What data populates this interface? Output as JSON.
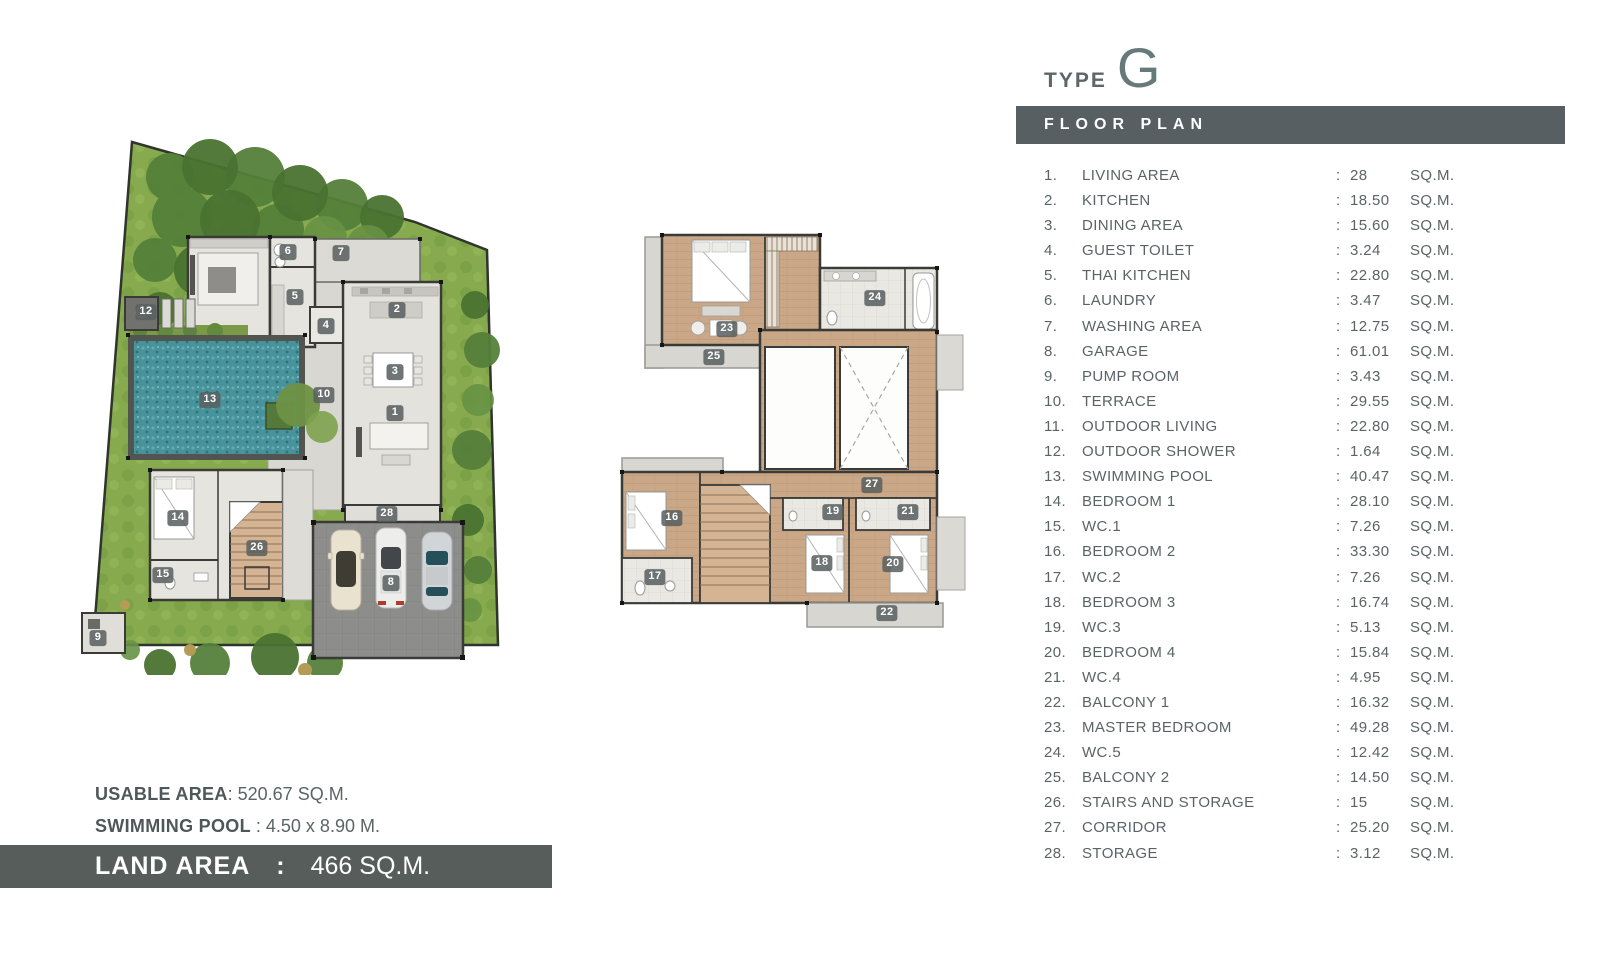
{
  "header": {
    "type_label": "TYPE",
    "type_value": "G",
    "floor_plan_title": "FLOOR PLAN"
  },
  "rooms": [
    {
      "no": "1.",
      "name": "LIVING AREA",
      "value": "28",
      "unit": "SQ.M."
    },
    {
      "no": "2.",
      "name": "KITCHEN",
      "value": "18.50",
      "unit": "SQ.M."
    },
    {
      "no": "3.",
      "name": "DINING AREA",
      "value": "15.60",
      "unit": "SQ.M."
    },
    {
      "no": "4.",
      "name": "GUEST TOILET",
      "value": "3.24",
      "unit": "SQ.M."
    },
    {
      "no": "5.",
      "name": "THAI KITCHEN",
      "value": "22.80",
      "unit": "SQ.M."
    },
    {
      "no": "6.",
      "name": "LAUNDRY",
      "value": "3.47",
      "unit": "SQ.M."
    },
    {
      "no": "7.",
      "name": "WASHING AREA",
      "value": "12.75",
      "unit": "SQ.M."
    },
    {
      "no": "8.",
      "name": "GARAGE",
      "value": "61.01",
      "unit": "SQ.M."
    },
    {
      "no": "9.",
      "name": "PUMP ROOM",
      "value": "3.43",
      "unit": "SQ.M."
    },
    {
      "no": "10.",
      "name": "TERRACE",
      "value": "29.55",
      "unit": "SQ.M."
    },
    {
      "no": "11.",
      "name": "OUTDOOR LIVING",
      "value": "22.80",
      "unit": "SQ.M."
    },
    {
      "no": "12.",
      "name": "OUTDOOR SHOWER",
      "value": "1.64",
      "unit": "SQ.M."
    },
    {
      "no": "13.",
      "name": "SWIMMING POOL",
      "value": "40.47",
      "unit": "SQ.M."
    },
    {
      "no": "14.",
      "name": "BEDROOM 1",
      "value": "28.10",
      "unit": "SQ.M."
    },
    {
      "no": "15.",
      "name": "WC.1",
      "value": "7.26",
      "unit": "SQ.M."
    },
    {
      "no": "16.",
      "name": "BEDROOM 2",
      "value": "33.30",
      "unit": "SQ.M."
    },
    {
      "no": "17.",
      "name": "WC.2",
      "value": "7.26",
      "unit": "SQ.M."
    },
    {
      "no": "18.",
      "name": "BEDROOM 3",
      "value": "16.74",
      "unit": "SQ.M."
    },
    {
      "no": "19.",
      "name": "WC.3",
      "value": "5.13",
      "unit": "SQ.M."
    },
    {
      "no": "20.",
      "name": "BEDROOM 4",
      "value": "15.84",
      "unit": "SQ.M."
    },
    {
      "no": "21.",
      "name": "WC.4",
      "value": "4.95",
      "unit": "SQ.M."
    },
    {
      "no": "22.",
      "name": "BALCONY 1",
      "value": "16.32",
      "unit": "SQ.M."
    },
    {
      "no": "23.",
      "name": "MASTER BEDROOM",
      "value": "49.28",
      "unit": "SQ.M."
    },
    {
      "no": "24.",
      "name": "WC.5",
      "value": "12.42",
      "unit": "SQ.M."
    },
    {
      "no": "25.",
      "name": "BALCONY 2",
      "value": "14.50",
      "unit": "SQ.M."
    },
    {
      "no": "26.",
      "name": "STAIRS AND STORAGE",
      "value": "15",
      "unit": "SQ.M."
    },
    {
      "no": "27.",
      "name": "CORRIDOR",
      "value": "25.20",
      "unit": "SQ.M."
    },
    {
      "no": "28.",
      "name": "STORAGE",
      "value": "3.12",
      "unit": "SQ.M."
    }
  ],
  "summary": {
    "usable_area_label": "USABLE AREA",
    "usable_area_value": ": 520.67 SQ.M.",
    "pool_label": "SWIMMING POOL",
    "pool_value": " : 4.50 x  8.90 M.",
    "land_area_label": "LAND AREA",
    "land_area_sep": ":",
    "land_area_value": "466 SQ.M."
  },
  "plans": {
    "ground": {
      "title": "ground-floor-site-plan",
      "badges": [
        {
          "n": "6",
          "x": 218,
          "y": 147
        },
        {
          "n": "7",
          "x": 271,
          "y": 148
        },
        {
          "n": "5",
          "x": 225,
          "y": 192
        },
        {
          "n": "4",
          "x": 256,
          "y": 221
        },
        {
          "n": "2",
          "x": 327,
          "y": 205
        },
        {
          "n": "3",
          "x": 325,
          "y": 267
        },
        {
          "n": "1",
          "x": 325,
          "y": 308
        },
        {
          "n": "12",
          "x": 76,
          "y": 207
        },
        {
          "n": "13",
          "x": 140,
          "y": 295
        },
        {
          "n": "10",
          "x": 254,
          "y": 290
        },
        {
          "n": "14",
          "x": 108,
          "y": 413
        },
        {
          "n": "15",
          "x": 93,
          "y": 470
        },
        {
          "n": "26",
          "x": 187,
          "y": 443
        },
        {
          "n": "28",
          "x": 317,
          "y": 409
        },
        {
          "n": "8",
          "x": 321,
          "y": 478
        },
        {
          "n": "9",
          "x": 28,
          "y": 533
        }
      ]
    },
    "upper": {
      "title": "second-floor-plan",
      "badges": [
        {
          "n": "23",
          "x": 127,
          "y": 109
        },
        {
          "n": "24",
          "x": 275,
          "y": 78
        },
        {
          "n": "25",
          "x": 114,
          "y": 137
        },
        {
          "n": "27",
          "x": 272,
          "y": 265
        },
        {
          "n": "16",
          "x": 72,
          "y": 298
        },
        {
          "n": "17",
          "x": 55,
          "y": 357
        },
        {
          "n": "19",
          "x": 233,
          "y": 292
        },
        {
          "n": "21",
          "x": 308,
          "y": 292
        },
        {
          "n": "18",
          "x": 222,
          "y": 343
        },
        {
          "n": "20",
          "x": 293,
          "y": 344
        },
        {
          "n": "22",
          "x": 287,
          "y": 393
        }
      ]
    }
  },
  "colors": {
    "accent_bar": "#575f62",
    "list_text": "#5a6466",
    "pool_water": "#47929b",
    "grass": "#87ab4d",
    "wood_floor": "#c9a787",
    "garage_slab": "#8d8d8b"
  }
}
